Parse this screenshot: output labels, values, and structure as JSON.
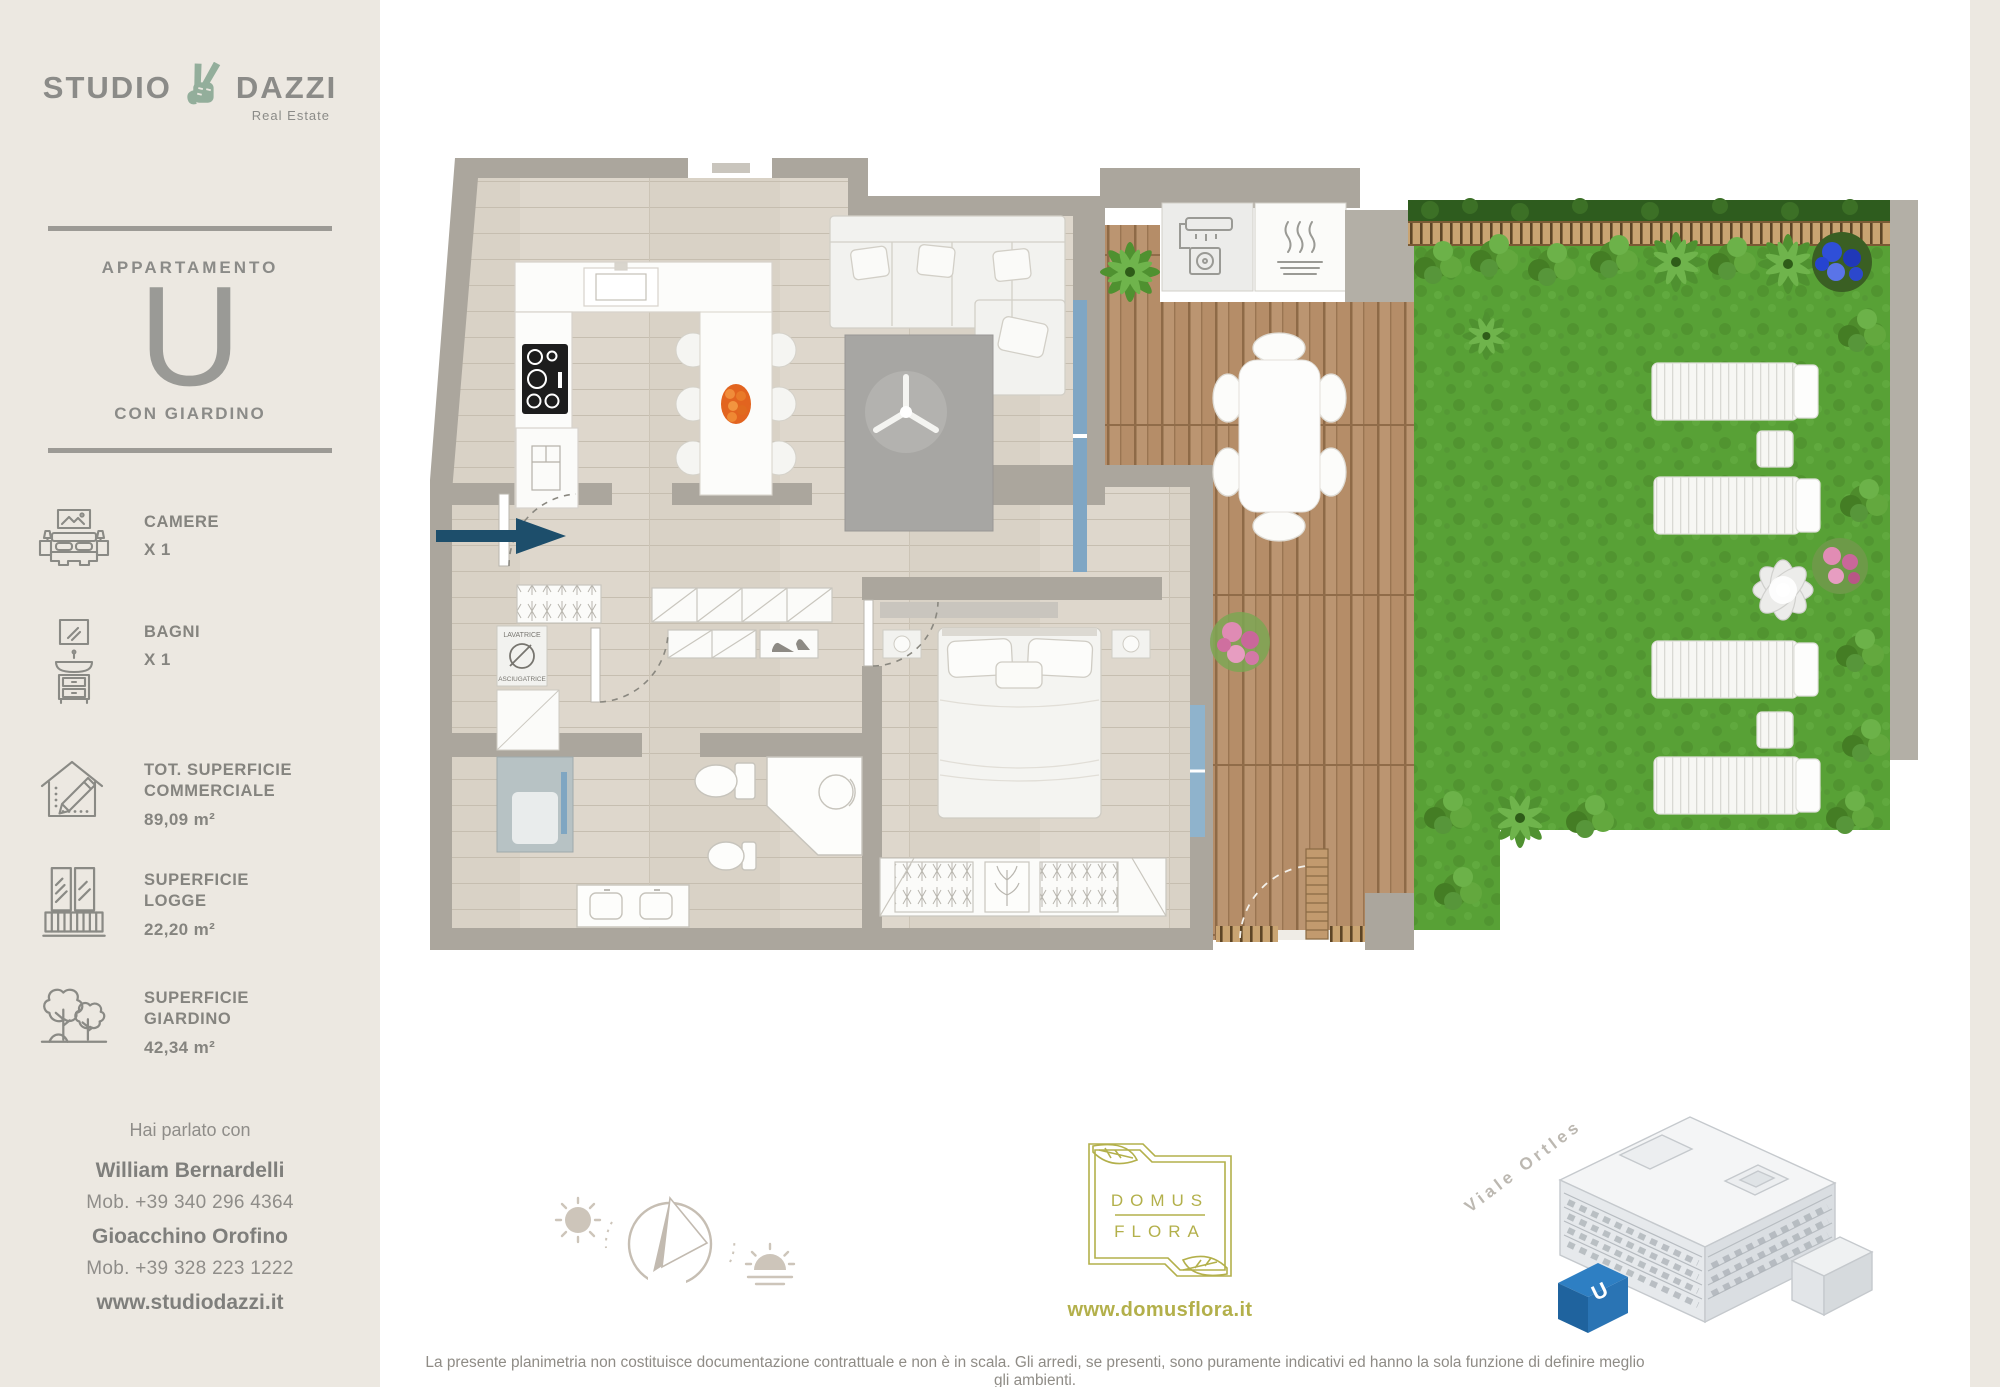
{
  "colors": {
    "sidebar_bg": "#ece8e1",
    "logo_green": "#93ae9b",
    "wall_gray": "#aba69d",
    "grass_green": "#58a136",
    "deck_brown": "#b28a67",
    "arrow_navy": "#1d4e6b",
    "domus_olive": "#b3b04b",
    "unit_blue": "#2a7abf"
  },
  "sidebar": {
    "logo": {
      "word1": "STUDIO",
      "word2": "DAZZI",
      "tagline": "Real Estate"
    },
    "apartment": {
      "eyebrow": "APPARTAMENTO",
      "letter": "U",
      "caption": "CON GIARDINO"
    },
    "stats": [
      {
        "icon": "bed-icon",
        "lines": [
          "CAMERE"
        ],
        "value": "X 1"
      },
      {
        "icon": "washbasin-icon",
        "lines": [
          "BAGNI"
        ],
        "value": "X 1"
      },
      {
        "icon": "house-pencil-icon",
        "lines": [
          "TOT. SUPERFICIE",
          "COMMERCIALE"
        ],
        "value": "89,09 m²"
      },
      {
        "icon": "balcony-icon",
        "lines": [
          "SUPERFICIE",
          "LOGGE"
        ],
        "value": "22,20 m²"
      },
      {
        "icon": "garden-trees-icon",
        "lines": [
          "SUPERFICIE",
          "GIARDINO"
        ],
        "value": "42,34 m²"
      }
    ],
    "contact": {
      "intro": "Hai parlato con",
      "agents": [
        {
          "name": "William Bernardelli",
          "phone": "Mob. +39 340 296 4364"
        },
        {
          "name": "Gioacchino Orofino",
          "phone": "Mob. +39 328 223 1222"
        }
      ],
      "website": "www.studiodazzi.it"
    }
  },
  "floorplan": {
    "laundry": {
      "top": "LAVATRICE",
      "bottom": "ASCIUGATRICE"
    },
    "compass": {
      "north_letter": "N"
    }
  },
  "footer": {
    "developer_logo": {
      "line1": "DOMUS",
      "line2": "FLORA"
    },
    "developer_site": "www.domusflora.it",
    "building": {
      "street_label": "Viale Ortles",
      "unit_label": "U"
    },
    "disclaimer": "La presente planimetria non costituisce documentazione contrattuale e non è in scala. Gli arredi, se presenti, sono puramente indicativi ed hanno la sola funzione di definire meglio gli ambienti."
  }
}
